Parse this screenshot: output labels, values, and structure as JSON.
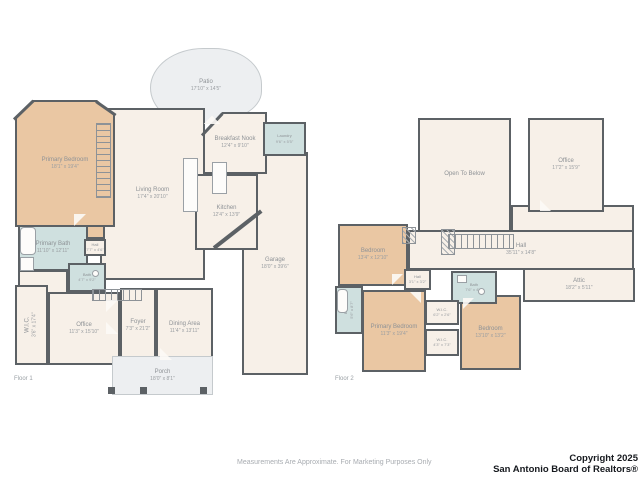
{
  "colors": {
    "wall": "#5c6165",
    "floor_fill": "#f7f0e8",
    "bedroom_fill": "#eac7a3",
    "bath_fill": "#cfe0df",
    "outdoor_fill": "#edeff1",
    "label_text": "#8e9296",
    "copyright_text": "#16191e"
  },
  "floor1": {
    "label": "Floor 1",
    "rooms": [
      {
        "name": "Patio",
        "dims": "17'10\" x 14'5\""
      },
      {
        "name": "Primary Bedroom",
        "dims": "18'1\" x 19'4\""
      },
      {
        "name": "Living Room",
        "dims": "17'4\" x 20'10\""
      },
      {
        "name": "Breakfast Nook",
        "dims": "12'4\" x 9'10\""
      },
      {
        "name": "Laundry",
        "dims": "9'6\" x 5'5\""
      },
      {
        "name": "Kitchen",
        "dims": "12'4\" x 13'9\""
      },
      {
        "name": "Garage",
        "dims": "18'0\" x 39'6\""
      },
      {
        "name": "Primary Bath",
        "dims": "11'10\" x 12'11\""
      },
      {
        "name": "Hall",
        "dims": "7'7\" x 4'6\""
      },
      {
        "name": "Bath",
        "dims": "4'7\" x 9'2\""
      },
      {
        "name": "W.I.C.",
        "dims": "3'6\" x 17'4\""
      },
      {
        "name": "Office",
        "dims": "11'3\" x 15'10\""
      },
      {
        "name": "Foyer",
        "dims": "7'3\" x 21'2\""
      },
      {
        "name": "Dining Area",
        "dims": "11'4\" x 13'11\""
      },
      {
        "name": "Porch",
        "dims": "18'0\" x 8'1\""
      }
    ]
  },
  "floor2": {
    "label": "Floor 2",
    "rooms": [
      {
        "name": "Open To Below",
        "dims": ""
      },
      {
        "name": "Office",
        "dims": "17'2\" x 15'9\""
      },
      {
        "name": "Hall",
        "dims": "35'11\" x 14'8\""
      },
      {
        "name": "Attic",
        "dims": "18'2\" x 5'11\""
      },
      {
        "name": "Bedroom",
        "dims": "13'4\" x 12'10\""
      },
      {
        "name": "Hall",
        "dims": "3'1\" x 3'2\""
      },
      {
        "name": "Bath",
        "dims": "7'6\" x 4'9\""
      },
      {
        "name": "W.I.C.",
        "dims": "6'2\" x 2'6\""
      },
      {
        "name": "Bath",
        "dims": "5'6\" x 8'7\""
      },
      {
        "name": "W.I.C.",
        "dims": "4'3\" x 7'3\""
      },
      {
        "name": "Primary Bedroom",
        "dims": "11'3\" x 19'4\""
      },
      {
        "name": "Bedroom",
        "dims": "13'10\" x 13'2\""
      }
    ]
  },
  "footer": {
    "disclaimer": "Measurements Are Approximate. For Marketing Purposes Only",
    "copyright_line1": "Copyright 2025",
    "copyright_line2": "San Antonio Board of Realtors®"
  }
}
